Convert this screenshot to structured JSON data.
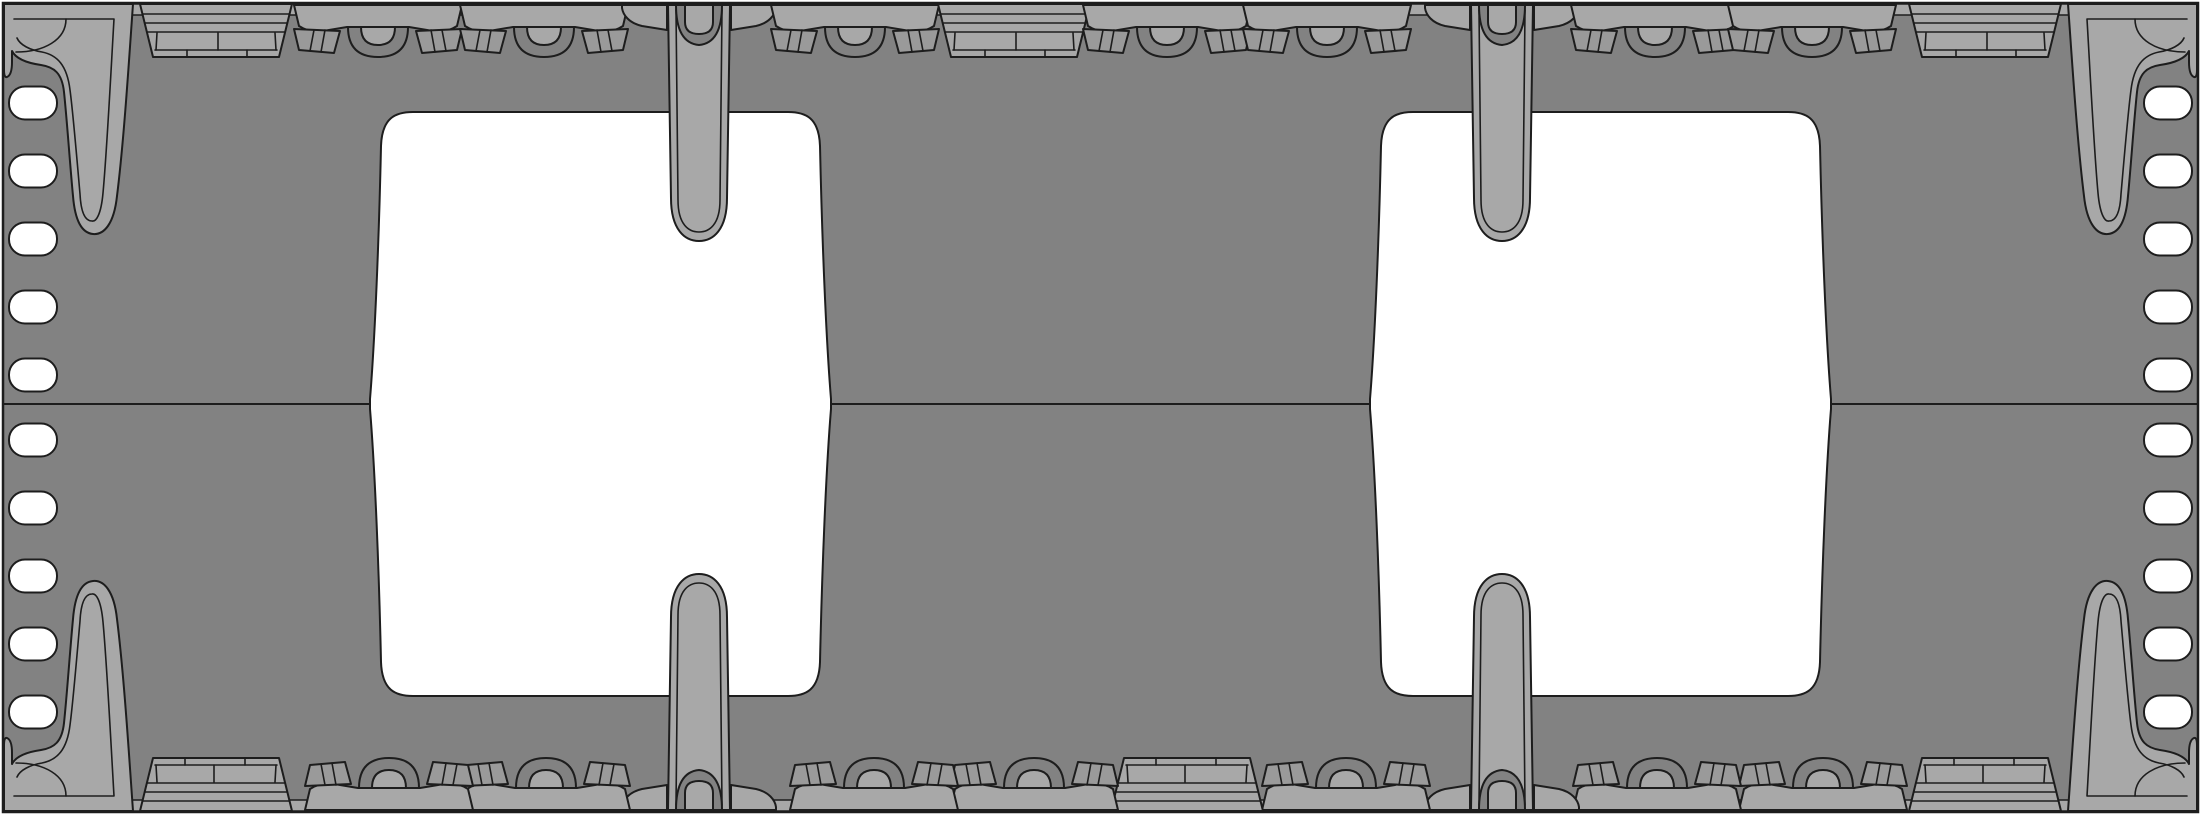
{
  "drawing": {
    "kind": "cad-part-top-view",
    "canvas": {
      "width": 2201,
      "height": 815
    },
    "colors": {
      "background": "#ffffff",
      "plate_body": "#828282",
      "feature_fill": "#a8a8a8",
      "facet_fill": "#9a9a9a",
      "outline": "#1d1d1d",
      "cutout_fill": "#ffffff"
    },
    "plate": {
      "x": 3,
      "y": 3,
      "width": 2195,
      "height": 809,
      "seam_y": 404
    },
    "rail": {
      "x1": 130,
      "x2": 2071,
      "y1": 4,
      "y2": 15
    },
    "edge_features_top": [
      {
        "type": "clip",
        "cx": 216
      },
      {
        "type": "tab",
        "cx": 378
      },
      {
        "type": "tab",
        "cx": 544
      },
      {
        "type": "pin",
        "cx": 699
      },
      {
        "type": "tab",
        "cx": 855
      },
      {
        "type": "clip",
        "cx": 1014
      },
      {
        "type": "tab",
        "cx": 1167
      },
      {
        "type": "tab",
        "cx": 1327
      },
      {
        "type": "pin",
        "cx": 1502
      },
      {
        "type": "tab",
        "cx": 1655
      },
      {
        "type": "tab",
        "cx": 1812
      },
      {
        "type": "clip",
        "cx": 1985
      }
    ],
    "bottom_edge_rule": "top edge rotated 180 degrees about plate center",
    "slots": {
      "per_side": 10,
      "x": 9,
      "width": 48,
      "height": 33,
      "corner_radius": 16,
      "centers_y": [
        103,
        171,
        239,
        307,
        375,
        440,
        508,
        576,
        644,
        712
      ],
      "right_column_rule": "mirror of left column"
    },
    "cutouts": {
      "count": 2,
      "left": {
        "x_min": 370,
        "x_max": 831,
        "y_top": 112,
        "y_bottom": 696
      },
      "right_rule": "mirror of left cutout about x=1100.5",
      "top_pin_tip_y": 241,
      "bottom_pin_tip_y": 574
    },
    "pins": {
      "top_centers_x": [
        699,
        1502
      ],
      "bottom_centers_x": [
        699,
        1502
      ]
    },
    "corner_brackets": [
      "top-left",
      "top-right",
      "bottom-left",
      "bottom-right"
    ],
    "seam": {
      "y": 404,
      "x1": 3,
      "x2": 2198
    }
  }
}
